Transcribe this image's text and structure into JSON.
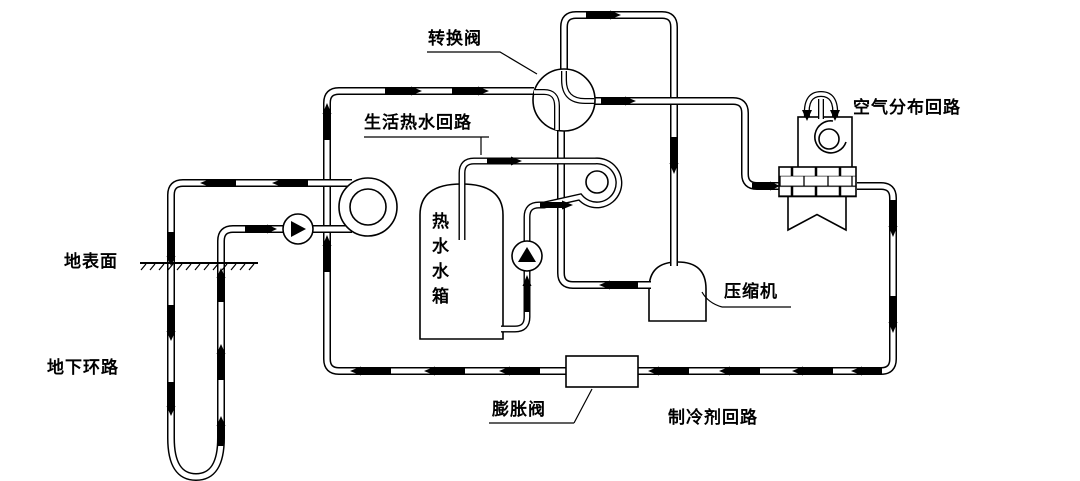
{
  "title": "地源热泵系统原理图",
  "colors": {
    "line": "#000000",
    "background": "#ffffff",
    "arrow_fill": "#000000"
  },
  "labels": {
    "reversing_valve": "转换阀",
    "domestic_hot_water_loop": "生活热水回路",
    "air_distribution_loop": "空气分布回路",
    "compressor": "压缩机",
    "ground_surface": "地表面",
    "underground_loop": "地下环路",
    "expansion_valve": "膨胀阀",
    "refrigerant_loop": "制冷剂回路",
    "hot_water_tank": "热水水箱"
  },
  "components": {
    "reversing_valve": "four-way-valve-circle",
    "ground_pump": "pump-circle-right-triangle",
    "tank_pump": "pump-circle-up-triangle",
    "ground_coil": "spiral-heat-exchanger",
    "tank_coil": "spiral-heat-exchanger",
    "compressor": "dome-vessel",
    "expansion_valve": "rectangle-on-pipe",
    "air_handler": "fan-box-with-coil-and-filter",
    "underground_loop": "u-tube",
    "flow_arrows": "black-arrow-segments"
  }
}
